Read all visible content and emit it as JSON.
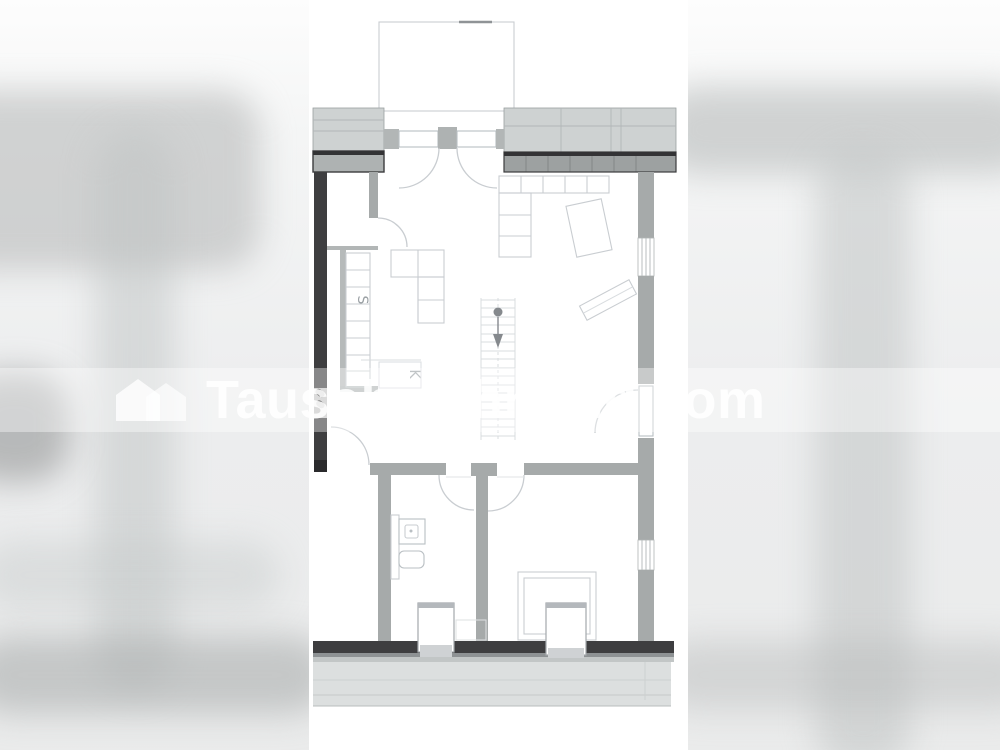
{
  "watermark": {
    "text": "Tauschwohnung.com"
  },
  "plan": {
    "labels": {
      "sink": "S",
      "kitchen": "K"
    }
  },
  "colors": {
    "wall_dark": "#3e3e40",
    "wall_gray": "#a6aaaa",
    "wall_band": "#9da1a1",
    "wall_light": "#ced2d2",
    "line_faint": "#c9cdd1",
    "stair_line": "#d8dcdf",
    "fixture_line": "#b9bfc3",
    "label_color": "#9aa0a4",
    "patio_fill": "#dcdfdf",
    "stair_marker": "#85898d"
  }
}
